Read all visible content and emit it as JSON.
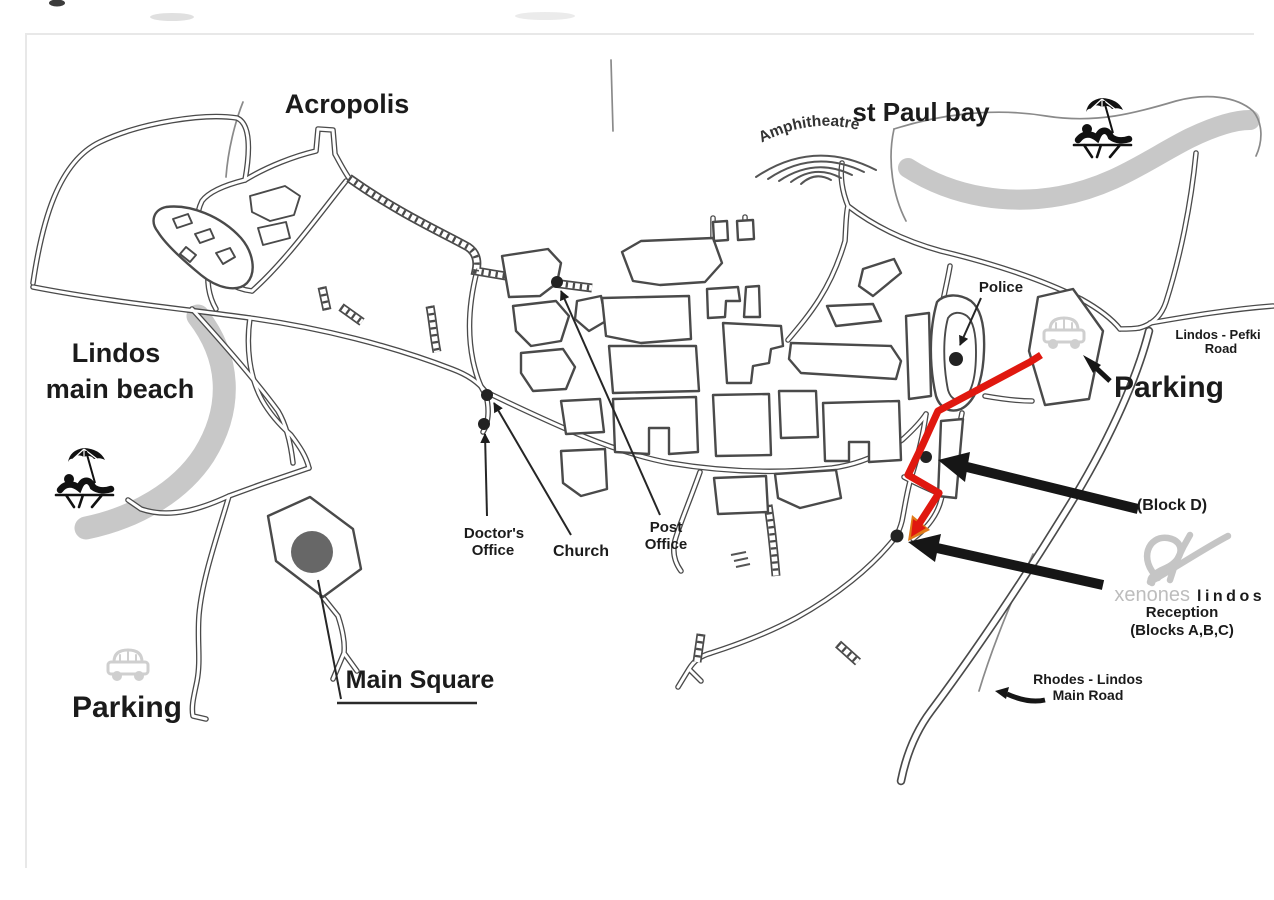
{
  "title": "Lindos town hand-drawn tourist map",
  "colors": {
    "background": "#ffffff",
    "road_outline": "#4a4a4a",
    "beach_gray": "#c8c8c8",
    "route_red": "#e0180f",
    "route_orange": "#e07a18",
    "arrow_black": "#161616",
    "square_fill": "#676767",
    "dot_fill": "#222222",
    "muted_gray": "#a3a3a3",
    "logo_gray": "#c5c5c5",
    "icon_gray": "#cfcfcf"
  },
  "labels": {
    "acropolis": "Acropolis",
    "st_paul_bay": "st Paul bay",
    "amphitheatre": "Amphitheatre",
    "beach_line1": "Lindos",
    "beach_line2": "main beach",
    "parking_left": "Parking",
    "parking_right": "Parking",
    "main_square": "Main Square",
    "police": "Police",
    "doctors_line1": "Doctor's",
    "doctors_line2": "Office",
    "church": "Church",
    "post_line1": "Post",
    "post_line2": "Office",
    "pefki_line1": "Lindos - Pefki",
    "pefki_line2": "Road",
    "rhodes_line1": "Rhodes - Lindos",
    "rhodes_line2": "Main Road",
    "block_d": "(Block D)",
    "brand_xenones": "xenones",
    "brand_lindos": "lindos",
    "reception": "Reception",
    "blocks_abc": "(Blocks A,B,C)"
  },
  "markers": {
    "police_dot": "police station",
    "post_office_dot": "post office",
    "church_dot": "church",
    "doctors_dot": "doctor's office",
    "block_d_dot": "Xenones Lindos Block D",
    "reception_dot": "Xenones Lindos reception blocks A,B,C",
    "main_square_circle": "main square"
  },
  "icons": [
    "sunbather-umbrella-icon",
    "car-parking-icon",
    "amphitheatre-arcs-icon",
    "xenones-lindos-logo-icon"
  ],
  "route": {
    "description": "red walking route from the parking area to Xenones Lindos reception"
  }
}
